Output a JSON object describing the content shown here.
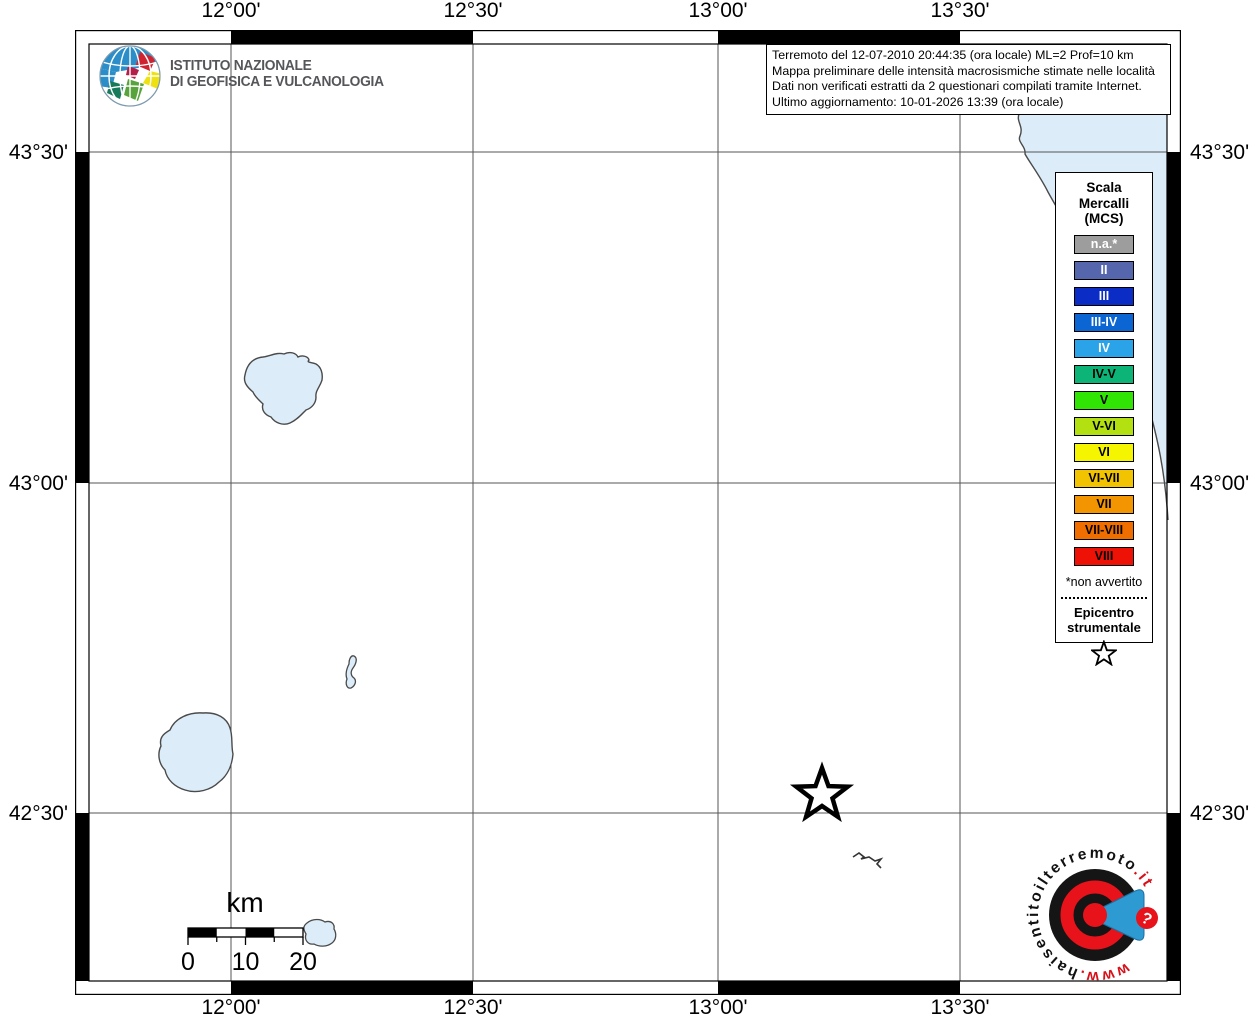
{
  "axes": {
    "top": [
      "12°00'",
      "12°30'",
      "13°00'",
      "13°30'"
    ],
    "bottom": [
      "12°00'",
      "12°30'",
      "13°00'",
      "13°30'"
    ],
    "left": [
      "43°30'",
      "43°00'",
      "42°30'"
    ],
    "right": [
      "43°30'",
      "43°00'",
      "42°30'"
    ]
  },
  "info_box": {
    "lines": [
      "Terremoto del 12-07-2010 20:44:35 (ora locale) ML=2 Prof=10 km",
      "Mappa preliminare delle intensità macrosismiche stimate nelle località",
      "Dati non verificati estratti da 2 questionari compilati tramite Internet.",
      "Ultimo aggiornamento: 10-01-2026 13:39 (ora locale)"
    ]
  },
  "ingv": {
    "name_line1": "ISTITUTO NAZIONALE",
    "name_line2": "DI GEOFISICA E VULCANOLOGIA",
    "globe_icon": "ingv-globe-icon"
  },
  "legend": {
    "title_lines": [
      "Scala",
      "Mercalli",
      "(MCS)"
    ],
    "items": [
      {
        "label": "n.a.*",
        "color": "#9d9d9d",
        "text": "#ffffff"
      },
      {
        "label": "II",
        "color": "#5566ad",
        "text": "#ffffff"
      },
      {
        "label": "III",
        "color": "#0b2dc6",
        "text": "#ffffff"
      },
      {
        "label": "III-IV",
        "color": "#0b65d2",
        "text": "#ffffff"
      },
      {
        "label": "IV",
        "color": "#2aa3e8",
        "text": "#ffffff"
      },
      {
        "label": "IV-V",
        "color": "#0cb478",
        "text": "#000000"
      },
      {
        "label": "V",
        "color": "#30e503",
        "text": "#000000"
      },
      {
        "label": "V-VI",
        "color": "#b2e011",
        "text": "#000000"
      },
      {
        "label": "VI",
        "color": "#f5f500",
        "text": "#000000"
      },
      {
        "label": "VI-VII",
        "color": "#f2c300",
        "text": "#000000"
      },
      {
        "label": "VII",
        "color": "#f29500",
        "text": "#000000"
      },
      {
        "label": "VII-VIII",
        "color": "#f06d00",
        "text": "#000000"
      },
      {
        "label": "VIII",
        "color": "#ee1206",
        "text": "#000000"
      }
    ],
    "footnote": "*non avvertito",
    "epicenter_title_lines": [
      "Epicentro",
      "strumentale"
    ],
    "epicenter_symbol": "star-icon"
  },
  "scale_bar": {
    "unit": "km",
    "labels": [
      "0",
      "10",
      "20"
    ]
  },
  "site_logo": {
    "prefix": "www.",
    "middle": "haisentitoilterremoto",
    "suffix": ".it",
    "badge": "?"
  },
  "map_colors": {
    "sea": "#dcedf9",
    "land": "#ffffff",
    "grid": "#555555"
  }
}
